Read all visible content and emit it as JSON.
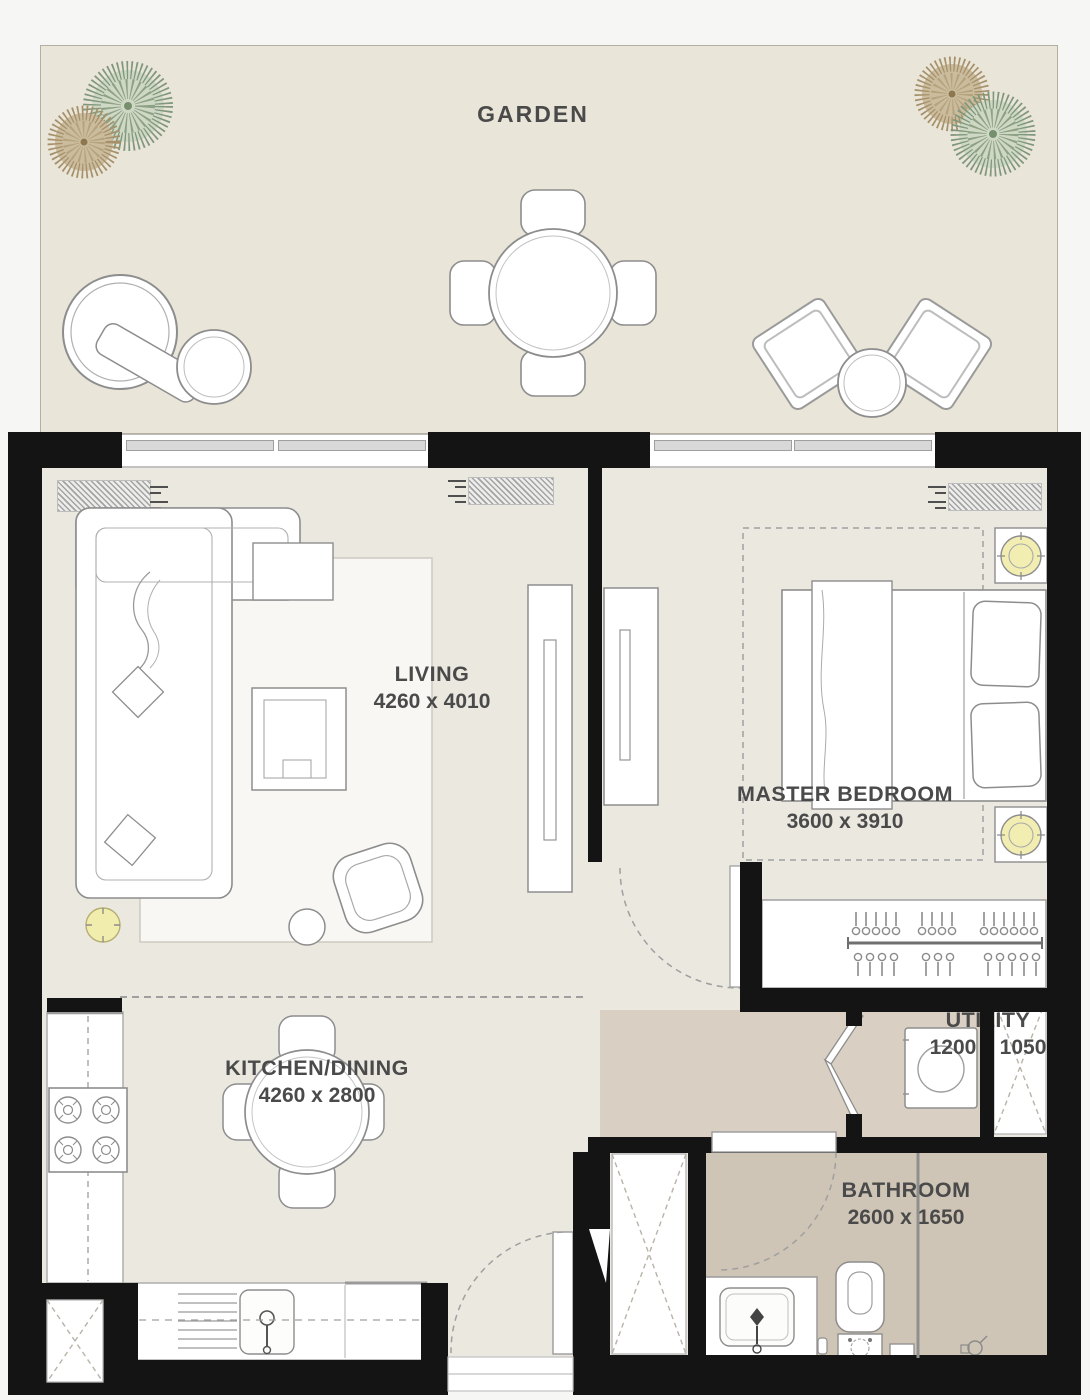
{
  "rooms": {
    "garden": {
      "label": "GARDEN"
    },
    "living": {
      "label": "LIVING",
      "dims": "4260 x 4010"
    },
    "master_bedroom": {
      "label": "MASTER BEDROOM",
      "dims": "3600 x 3910"
    },
    "kitchen_dining": {
      "label": "KITCHEN/DINING",
      "dims": "4260 x 2800"
    },
    "utility": {
      "label": "UTILITY",
      "dims": "1200 x 1050"
    },
    "bathroom": {
      "label": "BATHROOM",
      "dims": "2600 x 1650"
    }
  },
  "colors": {
    "wall": "#141414",
    "garden_floor": "#e9e5d8",
    "interior_floor": "#ebe8e0",
    "wet_floor": "#cfc5b6",
    "corridor_floor": "#d9d0c3",
    "lamp_accent": "#f0edad",
    "label_text": "#4a4a4a"
  }
}
